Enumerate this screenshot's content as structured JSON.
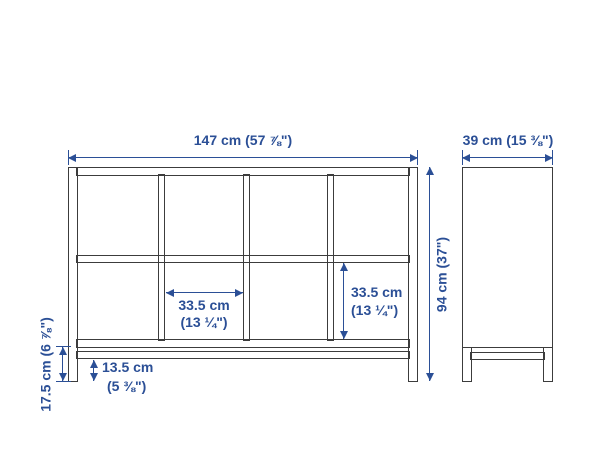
{
  "colors": {
    "dimension": "#2b4f96",
    "outline": "#3c3c3c",
    "background": "#ffffff"
  },
  "dimensions": {
    "overall_width": "147 cm (57 ⅞\")",
    "overall_depth": "39 cm (15 ⅜\")",
    "overall_height": "94 cm (37\")",
    "compartment_width": [
      "33.5 cm",
      "(13 ¼\")"
    ],
    "compartment_height": [
      "33.5 cm",
      "(13 ¼\")"
    ],
    "base_clearance": [
      "13.5 cm",
      "(5 ⅜\")"
    ],
    "leg_height": "17.5 cm (6 ⅞\")"
  }
}
